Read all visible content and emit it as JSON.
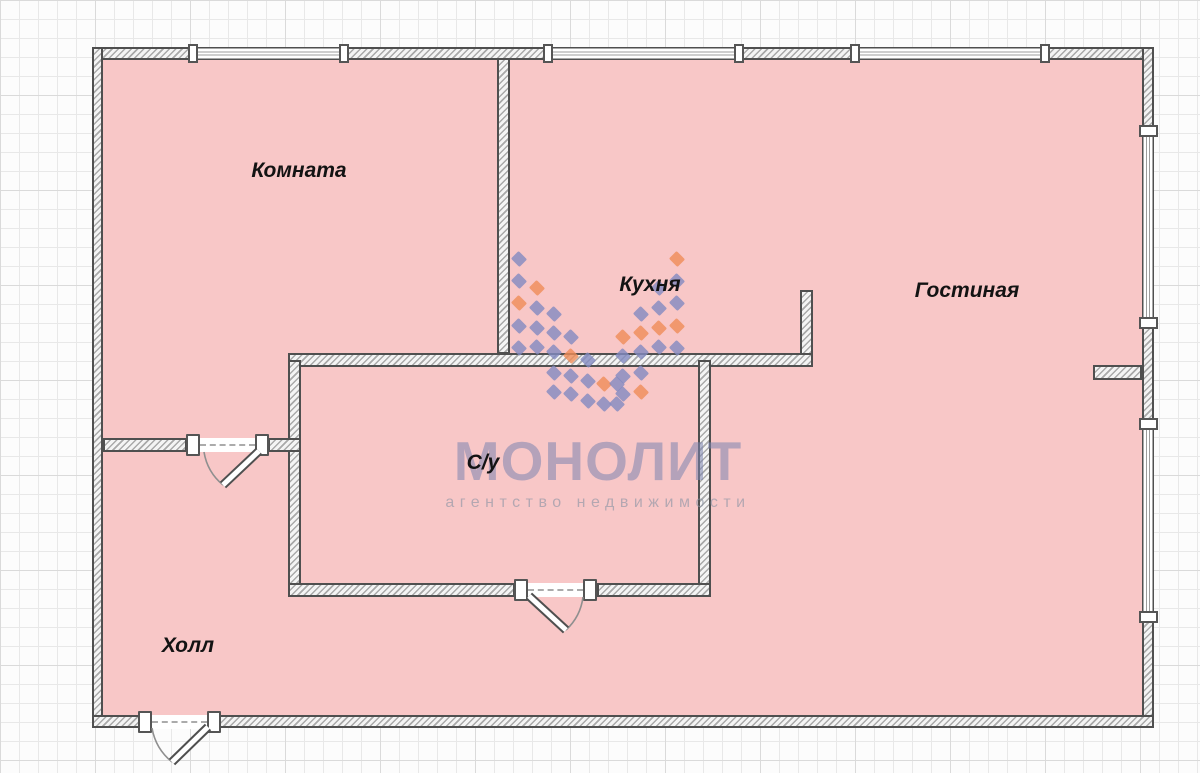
{
  "plan": {
    "type": "apartment-floor-plan",
    "rooms": [
      {
        "name": "Комната",
        "x": 299,
        "y": 171
      },
      {
        "name": "Кухня",
        "x": 650,
        "y": 285
      },
      {
        "name": "Гостиная",
        "x": 967,
        "y": 291
      },
      {
        "name": "С/у",
        "x": 483,
        "y": 463
      },
      {
        "name": "Холл",
        "x": 188,
        "y": 646
      }
    ],
    "watermark": {
      "title": "МОНОЛИТ",
      "subtitle": "агентство недвижимости",
      "title_color": "#7d84b0",
      "subtitle_color": "#8c94a5",
      "diamond_blue": "#8289c0",
      "diamond_orange": "#ef8c58",
      "diamonds": [
        {
          "x": 519,
          "y": 259,
          "c": "b"
        },
        {
          "x": 519,
          "y": 281,
          "c": "b"
        },
        {
          "x": 519,
          "y": 303,
          "c": "o"
        },
        {
          "x": 519,
          "y": 326,
          "c": "b"
        },
        {
          "x": 519,
          "y": 348,
          "c": "b"
        },
        {
          "x": 537,
          "y": 288,
          "c": "o"
        },
        {
          "x": 537,
          "y": 308,
          "c": "b"
        },
        {
          "x": 537,
          "y": 328,
          "c": "b"
        },
        {
          "x": 537,
          "y": 347,
          "c": "b"
        },
        {
          "x": 554,
          "y": 314,
          "c": "b"
        },
        {
          "x": 554,
          "y": 333,
          "c": "b"
        },
        {
          "x": 554,
          "y": 352,
          "c": "b"
        },
        {
          "x": 554,
          "y": 373,
          "c": "b"
        },
        {
          "x": 554,
          "y": 392,
          "c": "b"
        },
        {
          "x": 571,
          "y": 337,
          "c": "b"
        },
        {
          "x": 571,
          "y": 356,
          "c": "o"
        },
        {
          "x": 571,
          "y": 376,
          "c": "b"
        },
        {
          "x": 571,
          "y": 394,
          "c": "b"
        },
        {
          "x": 588,
          "y": 360,
          "c": "b"
        },
        {
          "x": 588,
          "y": 381,
          "c": "b"
        },
        {
          "x": 588,
          "y": 401,
          "c": "b"
        },
        {
          "x": 604,
          "y": 384,
          "c": "o"
        },
        {
          "x": 604,
          "y": 404,
          "c": "b"
        },
        {
          "x": 677,
          "y": 259,
          "c": "o"
        },
        {
          "x": 677,
          "y": 281,
          "c": "b"
        },
        {
          "x": 677,
          "y": 303,
          "c": "b"
        },
        {
          "x": 677,
          "y": 326,
          "c": "o"
        },
        {
          "x": 677,
          "y": 348,
          "c": "b"
        },
        {
          "x": 659,
          "y": 288,
          "c": "b"
        },
        {
          "x": 659,
          "y": 308,
          "c": "b"
        },
        {
          "x": 659,
          "y": 328,
          "c": "o"
        },
        {
          "x": 659,
          "y": 347,
          "c": "b"
        },
        {
          "x": 641,
          "y": 314,
          "c": "b"
        },
        {
          "x": 641,
          "y": 333,
          "c": "o"
        },
        {
          "x": 641,
          "y": 352,
          "c": "b"
        },
        {
          "x": 641,
          "y": 373,
          "c": "b"
        },
        {
          "x": 641,
          "y": 392,
          "c": "o"
        },
        {
          "x": 623,
          "y": 337,
          "c": "o"
        },
        {
          "x": 623,
          "y": 356,
          "c": "b"
        },
        {
          "x": 623,
          "y": 376,
          "c": "b"
        },
        {
          "x": 623,
          "y": 394,
          "c": "b"
        },
        {
          "x": 617,
          "y": 384,
          "c": "b"
        },
        {
          "x": 617,
          "y": 404,
          "c": "b"
        }
      ]
    },
    "colors": {
      "room_fill": "#f8c7c7",
      "wall_hatch": "#a9a9a9",
      "wall_border": "#4f4f4f",
      "grid_light": "#e8e8e8",
      "grid_dark": "#dadada"
    },
    "counts": {
      "windows": 5,
      "doors": 3
    }
  }
}
